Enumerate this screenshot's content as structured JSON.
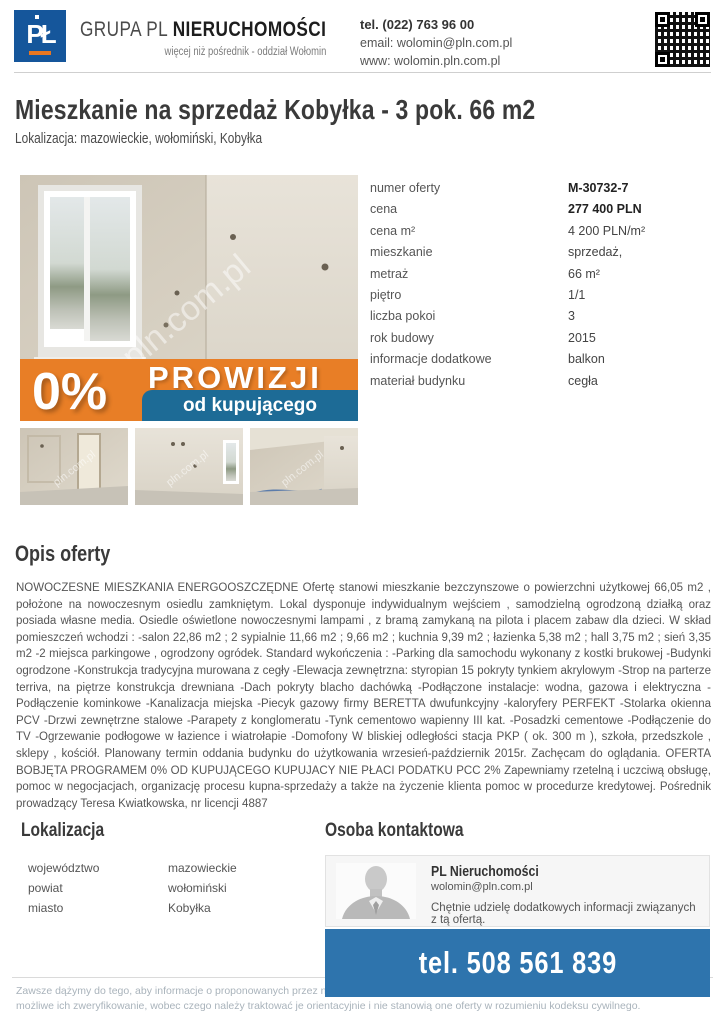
{
  "header": {
    "logo": {
      "monogram": "PŁ",
      "brand_prefix": "GRUPA PL ",
      "brand_bold": "NIERUCHOMOŚCI",
      "tagline": "więcej niż pośrednik - oddział Wołomin"
    },
    "contact": {
      "phone": "tel. (022) 763 96 00",
      "email": "email: wolomin@pln.com.pl",
      "www": "www: wolomin.pln.com.pl"
    },
    "qr_icon": "qr-code"
  },
  "listing": {
    "title": "Mieszkanie na sprzedaż Kobyłka - 3 pok. 66 m2",
    "location_line": "Lokalizacja: mazowieckie, wołomiński, Kobyłka",
    "photo": {
      "watermark": "pln.com.pl",
      "badge": {
        "percent": "0%",
        "word": "PROWIZJI",
        "sub": "od kupującego"
      }
    },
    "details": [
      {
        "label": "numer oferty",
        "value": "M-30732-7"
      },
      {
        "label": "cena",
        "value": "277 400 PLN"
      },
      {
        "label": "cena m²",
        "value": "4 200 PLN/m²"
      },
      {
        "label": "mieszkanie",
        "value": "sprzedaż,"
      },
      {
        "label": "metraż",
        "value": "66 m²"
      },
      {
        "label": "piętro",
        "value": "1/1"
      },
      {
        "label": "liczba pokoi",
        "value": "3"
      },
      {
        "label": "rok budowy",
        "value": "2015"
      },
      {
        "label": "informacje dodatkowe",
        "value": "balkon"
      },
      {
        "label": "materiał budynku",
        "value": "cegła"
      }
    ]
  },
  "description": {
    "heading": "Opis oferty",
    "text": "NOWOCZESNE MIESZKANIA ENERGOOSZCZĘDNE Ofertę stanowi mieszkanie bezczynszowe o powierzchni użytkowej 66,05 m2 , położone na nowoczesnym osiedlu zamkniętym. Lokal dysponuje indywidualnym wejściem , samodzielną ogrodzoną działką oraz posiada własne media. Osiedle oświetlone nowoczesnymi lampami , z bramą zamykaną na pilota i placem zabaw dla dzieci. W skład pomieszczeń wchodzi : -salon 22,86 m2 ; 2 sypialnie 11,66 m2 ; 9,66 m2 ; kuchnia 9,39 m2 ; łazienka 5,38 m2 ; hall 3,75 m2 ; sień 3,35 m2 -2 miejsca parkingowe , ogrodzony ogródek. Standard wykończenia : -Parking dla samochodu wykonany z kostki brukowej -Budynki ogrodzone -Konstrukcja tradycyjna murowana z cegły -Elewacja zewnętrzna: styropian 15 pokryty tynkiem akrylowym -Strop na parterze terriva, na piętrze konstrukcja drewniana -Dach pokryty blacho dachówką -Podłączone instalacje: wodna, gazowa i elektryczna -Podłączenie kominkowe -Kanalizacja miejska -Piecyk gazowy firmy BERETTA dwufunkcyjny -kaloryfery PERFEKT -Stolarka okienna PCV -Drzwi zewnętrzne stalowe -Parapety z konglomeratu -Tynk cementowo wapienny III kat. -Posadzki cementowe -Podłączenie do TV -Ogrzewanie podłogowe w łazience i wiatrołapie -Domofony W bliskiej odległości stacja PKP ( ok. 300 m ), szkoła, przedszkole , sklepy , kościół. Planowany termin oddania budynku do użytkowania wrzesień-październik 2015r. Zachęcam do oglądania. OFERTA BOBJĘTA PROGRAMEM 0% OD KUPUJĄCEGO KUPUJACY NIE PŁACI PODATKU PCC 2% Zapewniamy rzetelną i uczciwą obsługę, pomoc w negocjacjach, organizację procesu kupna-sprzedaży a także na życzenie klienta pomoc w procedurze kredytowej. Pośrednik prowadzący Teresa Kwiatkowska, nr licencji 4887"
  },
  "location_section": {
    "heading": "Lokalizacja",
    "rows": [
      {
        "label": "województwo",
        "value": "mazowieckie"
      },
      {
        "label": "powiat",
        "value": "wołomiński"
      },
      {
        "label": "miasto",
        "value": "Kobyłka"
      }
    ]
  },
  "contact_section": {
    "heading": "Osoba kontaktowa",
    "name": "PL Nieruchomości",
    "email": "wolomin@pln.com.pl",
    "line1": "Chętnie udzielę dodatkowych informacji związanych z tą ofertą.",
    "line2": "Zapraszam do kontaktu!",
    "phone": "tel. 508 561 839"
  },
  "footer": {
    "line1": "Zawsze dążymy do tego, aby informacje o proponowanych przez nas ofertach były jak",
    "line2": "możliwe ich zweryfikowanie, wobec czego należy traktować je orientacyjnie i nie stanowią one oferty w rozumieniu kodeksu cywilnego."
  },
  "colors": {
    "brand_blue": "#15569b",
    "accent_orange": "#e87e26",
    "badge_blue": "#1d6b96",
    "phone_bar_blue": "#2e74ad"
  }
}
